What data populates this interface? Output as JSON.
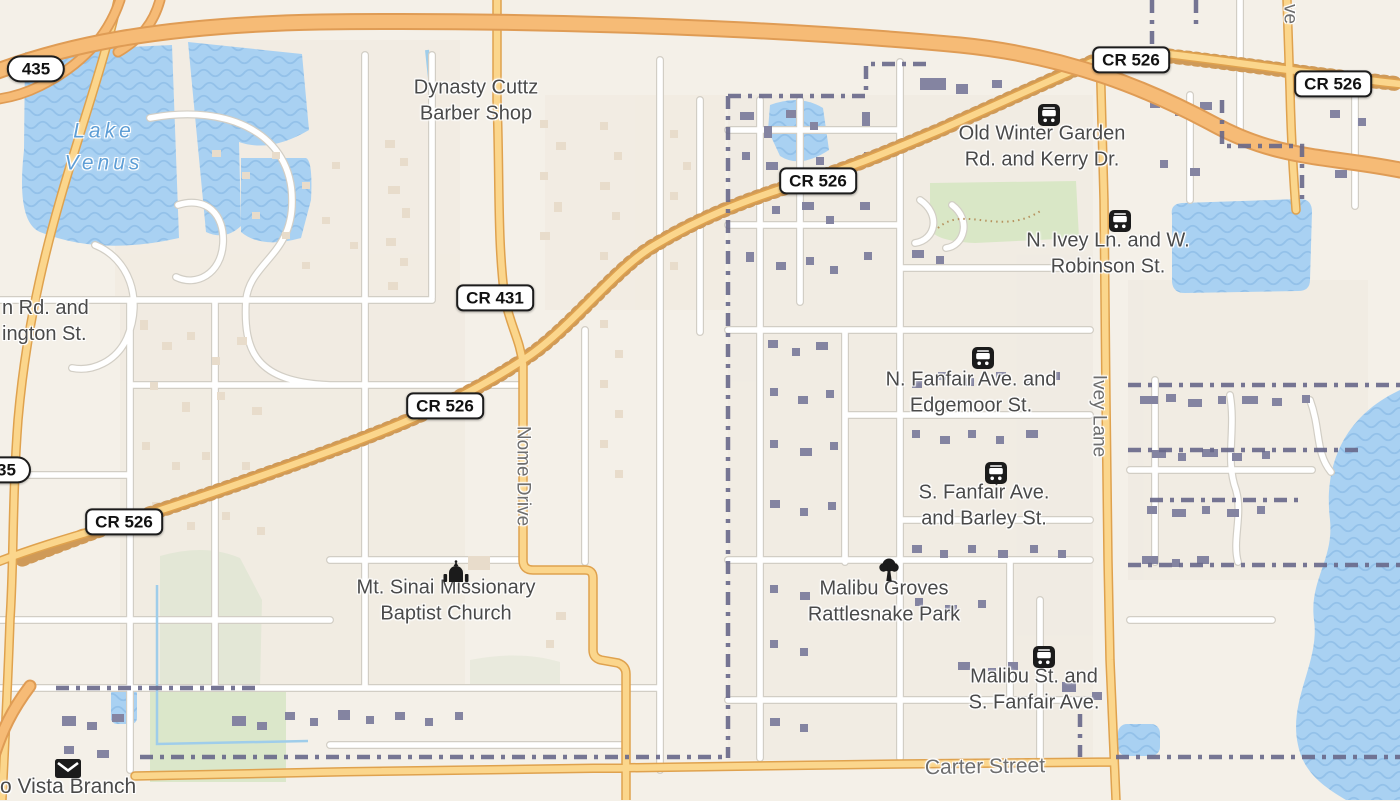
{
  "map": {
    "shields": {
      "s435": "435",
      "s435_partial": "35",
      "cr526": "CR 526",
      "cr431": "CR 431"
    },
    "water_labels": {
      "lake_venus": {
        "line1": "Lake",
        "line2": "Venus"
      }
    },
    "poi_labels": {
      "dynasty": {
        "line1": "Dynasty Cuttz",
        "line2": "Barber Shop"
      },
      "old_winter": {
        "line1": "Old Winter Garden",
        "line2": "Rd. and Kerry Dr."
      },
      "ivey_robinson": {
        "line1": "N. Ivey Ln. and W.",
        "line2": "Robinson St."
      },
      "fanfair_edgemoor": {
        "line1": "N. Fanfair Ave. and",
        "line2": "Edgemoor St."
      },
      "fanfair_barley": {
        "line1": "S. Fanfair Ave.",
        "line2": "and Barley St."
      },
      "malibu_park": {
        "line1": "Malibu Groves",
        "line2": "Rattlesnake Park"
      },
      "malibu_fanfair": {
        "line1": "Malibu St. and",
        "line2": "S. Fanfair Ave."
      },
      "mt_sinai": {
        "line1": "Mt. Sinai Missionary",
        "line2": "Baptist Church"
      },
      "truncated_rd": {
        "line1": "n Rd. and",
        "line2": "ington St."
      },
      "vista_branch": "o Vista Branch"
    },
    "street_labels": {
      "nome": "Nome Drive",
      "ivey": "Ivey Lane",
      "carter": "Carter Street",
      "ave_partial": "ve"
    },
    "icons": [
      "bus-stop-icon",
      "church-icon",
      "tree-icon",
      "post-office-icon"
    ],
    "colors": {
      "land": "#f4f0e8",
      "water": "#a9d1f2",
      "water_wave": "#93c1e9",
      "motorway": "#f6bb76",
      "motorway_casing": "#df9c55",
      "secondary_road": "#fbd68c",
      "secondary_casing": "#dfa24e",
      "minor_road": "#ffffff",
      "minor_casing": "#d2cec5",
      "boundary": "#68688a",
      "building_west": "#e8dccb",
      "building_east": "#8484a1",
      "green_area": "#d9e7c6",
      "label_text": "#4a4a4a",
      "water_label_text": "#5e9ed6"
    }
  }
}
